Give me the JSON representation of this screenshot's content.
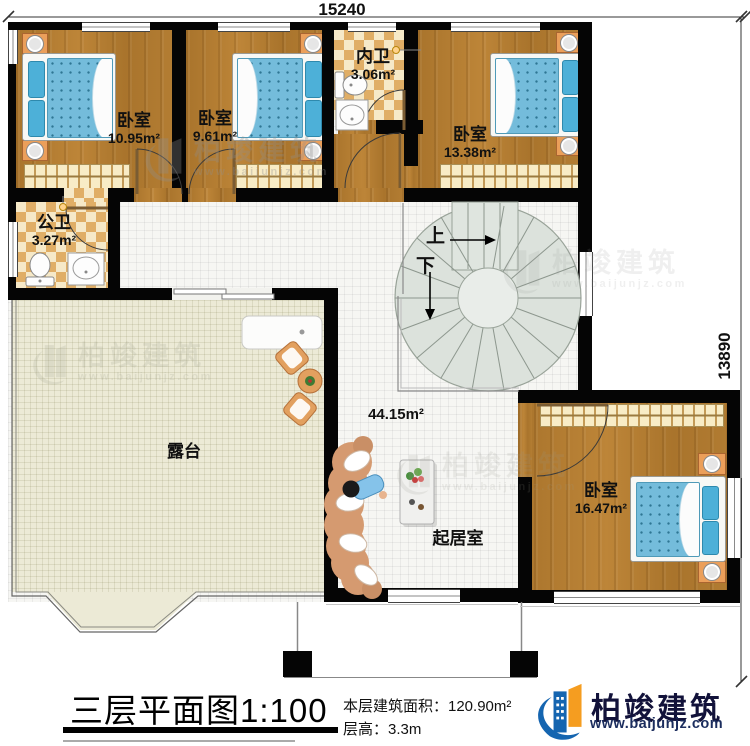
{
  "plan": {
    "dimension_top": "15240",
    "dimension_right": "13890",
    "rooms": {
      "bedroom1": {
        "name": "卧室",
        "area": "10.95m²"
      },
      "bedroom2": {
        "name": "卧室",
        "area": "9.61m²"
      },
      "inner_bath": {
        "name": "内卫",
        "area": "3.06m²"
      },
      "bedroom3": {
        "name": "卧室",
        "area": "13.38m²"
      },
      "public_bath": {
        "name": "公卫",
        "area": "3.27m²"
      },
      "terrace": {
        "name": "露台"
      },
      "living_room": {
        "name": "起居室",
        "area": "44.15m²"
      },
      "bedroom4": {
        "name": "卧室",
        "area": "16.47m²"
      }
    },
    "stairs": {
      "up_label": "上",
      "down_label": "下"
    }
  },
  "footer": {
    "title": "三层平面图1:100",
    "floor_area": "本层建筑面积：120.90m²",
    "floor_height": "层高：3.3m"
  },
  "brand": {
    "name": "柏竣建筑",
    "website": "www.baijunjz.com"
  },
  "watermark": {
    "name": "柏竣建筑",
    "website": "www.baijunjz.com"
  },
  "colors": {
    "wall": "#050505",
    "wood_floor": "#ad782f",
    "checker_tile": "#e0ae66",
    "terrace_floor": "#ecead6",
    "bed_blue": "#74bcdb",
    "stair_fill": "#dce2dc",
    "logo_blue": "#1565b0",
    "logo_orange": "#f59d20"
  }
}
